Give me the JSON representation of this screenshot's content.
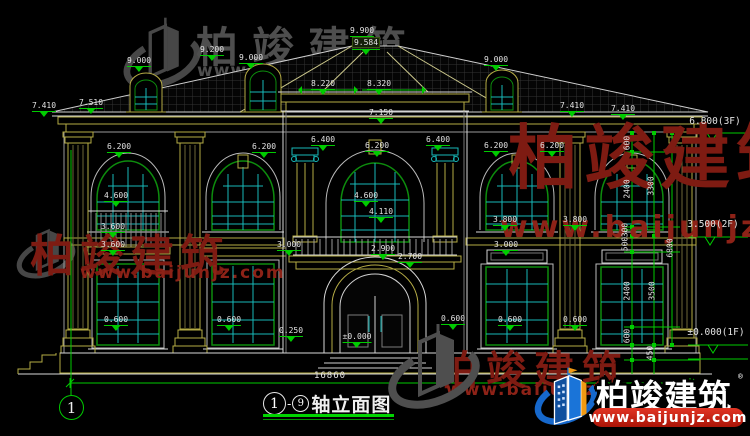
{
  "drawing": {
    "title": {
      "from": "1",
      "dash": "-",
      "to": "9",
      "name": "轴立面图"
    },
    "axis_label": "1"
  },
  "watermark": {
    "brand": "柏竣建筑",
    "url": "www.baijunjz.com"
  },
  "logo": {
    "brand": "柏竣建筑",
    "url": "www.baijunjz.com",
    "reg": "®"
  },
  "labels": [
    {
      "t": "9.900",
      "x": 362,
      "y": 26,
      "k": "e"
    },
    {
      "t": "9.584",
      "x": 366,
      "y": 37,
      "k": "hl"
    },
    {
      "t": "9.000",
      "x": 139,
      "y": 56,
      "k": "e"
    },
    {
      "t": "9.200",
      "x": 212,
      "y": 45,
      "k": "e"
    },
    {
      "t": "9.000",
      "x": 251,
      "y": 53,
      "k": "e"
    },
    {
      "t": "9.000",
      "x": 496,
      "y": 55,
      "k": "e"
    },
    {
      "t": "8.220",
      "x": 323,
      "y": 79,
      "k": "e"
    },
    {
      "t": "8.320",
      "x": 379,
      "y": 79,
      "k": "e"
    },
    {
      "t": "7.150",
      "x": 381,
      "y": 108,
      "k": "e"
    },
    {
      "t": "7.410",
      "x": 44,
      "y": 101,
      "k": "e"
    },
    {
      "t": "7.510",
      "x": 91,
      "y": 98,
      "k": "e"
    },
    {
      "t": "7.410",
      "x": 572,
      "y": 101,
      "k": "e"
    },
    {
      "t": "7.410",
      "x": 623,
      "y": 104,
      "k": "e"
    },
    {
      "t": "6.200",
      "x": 119,
      "y": 142,
      "k": "e"
    },
    {
      "t": "6.200",
      "x": 264,
      "y": 142,
      "k": "e"
    },
    {
      "t": "6.400",
      "x": 323,
      "y": 135,
      "k": "e"
    },
    {
      "t": "6.200",
      "x": 377,
      "y": 141,
      "k": "e"
    },
    {
      "t": "6.400",
      "x": 438,
      "y": 135,
      "k": "e"
    },
    {
      "t": "6.200",
      "x": 496,
      "y": 141,
      "k": "e"
    },
    {
      "t": "6.200",
      "x": 552,
      "y": 141,
      "k": "e"
    },
    {
      "t": "4.600",
      "x": 116,
      "y": 191,
      "k": "e"
    },
    {
      "t": "4.600",
      "x": 366,
      "y": 191,
      "k": "e"
    },
    {
      "t": "4.110",
      "x": 381,
      "y": 207,
      "k": "e"
    },
    {
      "t": "3.600",
      "x": 113,
      "y": 222,
      "k": "e"
    },
    {
      "t": "3.600",
      "x": 113,
      "y": 240,
      "k": "e"
    },
    {
      "t": "3.800",
      "x": 505,
      "y": 215,
      "k": "e"
    },
    {
      "t": "3.800",
      "x": 575,
      "y": 215,
      "k": "e"
    },
    {
      "t": "3.000",
      "x": 289,
      "y": 240,
      "k": "e"
    },
    {
      "t": "3.000",
      "x": 506,
      "y": 240,
      "k": "e"
    },
    {
      "t": "2.900",
      "x": 383,
      "y": 244,
      "k": "e"
    },
    {
      "t": "2.700",
      "x": 410,
      "y": 252,
      "k": "e"
    },
    {
      "t": "0.600",
      "x": 116,
      "y": 315,
      "k": "e"
    },
    {
      "t": "0.600",
      "x": 229,
      "y": 315,
      "k": "e"
    },
    {
      "t": "0.250",
      "x": 291,
      "y": 326,
      "k": "e"
    },
    {
      "t": "±0.000",
      "x": 357,
      "y": 332,
      "k": "e"
    },
    {
      "t": "0.600",
      "x": 453,
      "y": 314,
      "k": "e"
    },
    {
      "t": "0.600",
      "x": 510,
      "y": 315,
      "k": "e"
    },
    {
      "t": "0.600",
      "x": 575,
      "y": 315,
      "k": "e"
    },
    {
      "t": "6.800(3F)",
      "x": 715,
      "y": 117,
      "k": "l"
    },
    {
      "t": "3.500(2F)",
      "x": 713,
      "y": 220,
      "k": "l"
    },
    {
      "t": "±0.000(1F)",
      "x": 716,
      "y": 328,
      "k": "l"
    },
    {
      "t": "600",
      "x": 627,
      "y": 143,
      "k": "v"
    },
    {
      "t": "2400",
      "x": 627,
      "y": 189,
      "k": "v"
    },
    {
      "t": "300",
      "x": 625,
      "y": 230,
      "k": "v"
    },
    {
      "t": "500",
      "x": 625,
      "y": 244,
      "k": "v"
    },
    {
      "t": "2400",
      "x": 627,
      "y": 291,
      "k": "v"
    },
    {
      "t": "600",
      "x": 627,
      "y": 336,
      "k": "v"
    },
    {
      "t": "450",
      "x": 650,
      "y": 353,
      "k": "v"
    },
    {
      "t": "3300",
      "x": 651,
      "y": 186,
      "k": "v"
    },
    {
      "t": "3500",
      "x": 652,
      "y": 291,
      "k": "v"
    },
    {
      "t": "6800",
      "x": 670,
      "y": 248,
      "k": "v"
    },
    {
      "t": "16860",
      "x": 330,
      "y": 371,
      "k": "d"
    }
  ]
}
